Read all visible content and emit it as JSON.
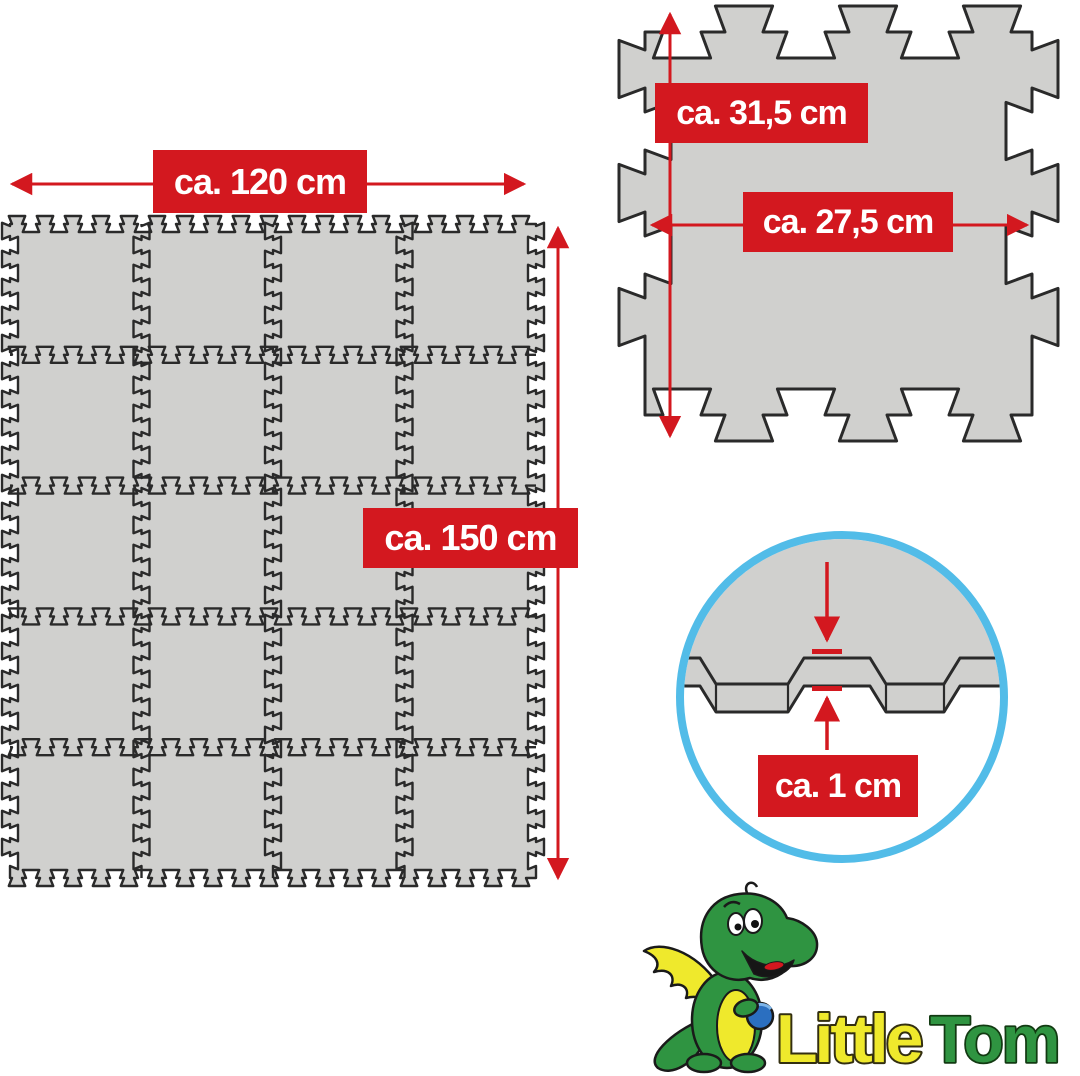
{
  "product": {
    "description": "Interlocking foam puzzle play mat dimension diagram",
    "grid": {
      "rows": 5,
      "cols": 4,
      "tile_count": 20
    }
  },
  "labels": {
    "mat_width": "ca. 120 cm",
    "mat_height": "ca. 150 cm",
    "tile_outer_height": "ca. 31,5 cm",
    "tile_inner_width": "ca. 27,5 cm",
    "thickness": "ca. 1 cm"
  },
  "logo": {
    "word1": "Little",
    "word2": "Tom"
  },
  "colors": {
    "red": "#d3181f",
    "tile_fill": "#d0d0ce",
    "outline": "#2a2a2a",
    "circle_blue": "#52bce8",
    "logo_green": "#2f9441",
    "logo_dark_green": "#1d6e2b",
    "logo_yellow": "#efe92c",
    "ball_blue": "#2b6fc0",
    "white": "#ffffff"
  }
}
